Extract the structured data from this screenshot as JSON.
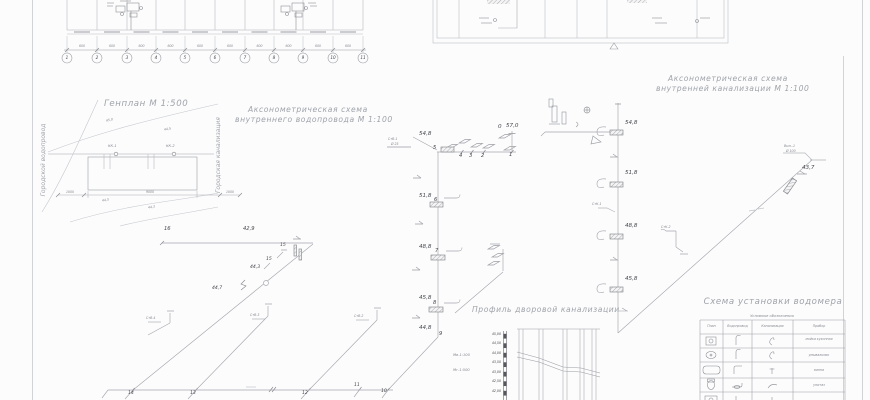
{
  "floor_plan": {
    "axes": [
      "1",
      "2",
      "3",
      "4",
      "5",
      "6",
      "7",
      "8",
      "9",
      "10",
      "11"
    ],
    "dims": [
      "600",
      "600",
      "600",
      "600",
      "600",
      "600",
      "600",
      "600",
      "600",
      "600"
    ]
  },
  "genplan": {
    "title": "Генплан  М 1:500",
    "left_main": "Городской водопровод",
    "right_main": "Городская канализация",
    "well1": "КК-1",
    "well2": "КК-2",
    "contours": [
      "45,0",
      "44,5",
      "44,5",
      "44,3"
    ],
    "dims": [
      "1000",
      "9000",
      "1000"
    ]
  },
  "water": {
    "title1": "Аксонометрическая схема",
    "title2": "внутреннего водопровода М 1:100",
    "riser_tag": "СтВ-1",
    "riser_dia": "Ø 25",
    "node0": "0",
    "elev0": "57,0",
    "top_nodes": [
      "4",
      "3",
      "2",
      "1"
    ],
    "levels": [
      {
        "elev": "54,8",
        "node": "5"
      },
      {
        "elev": "51,8",
        "node": "6"
      },
      {
        "elev": "48,8",
        "node": "7"
      },
      {
        "elev": "45,8",
        "node": "8"
      },
      {
        "elev": "44,8",
        "node": "9"
      }
    ],
    "left_node": "16",
    "left_elev": "42,9",
    "n15a": "15",
    "n15b": "15",
    "e443": "44,3",
    "e447": "44,7",
    "bottom_nodes": [
      "14",
      "13",
      "12",
      "11",
      "10"
    ],
    "tags": [
      "СтВ-4",
      "СтВ-3",
      "СтВ-2"
    ]
  },
  "sewer": {
    "title1": "Аксонометрическая схема",
    "title2": "внутренней канализации М 1:100",
    "levels": [
      "54,8",
      "51,8",
      "48,8",
      "45,8"
    ],
    "tag1": "СтК-1",
    "tag2": "СтК-2",
    "outlet1": "Вып.-1",
    "outlet2": "Ø 100",
    "outlet_elev": "43,7"
  },
  "profile": {
    "title": "Профиль дворовой канализации",
    "marks": [
      "45,00",
      "44,50",
      "44,00",
      "43,50",
      "43,00",
      "42,50",
      "42,00"
    ],
    "scale_v": "Мв-1:100",
    "scale_h": "Мг-1:500"
  },
  "meter": {
    "title": "Схема установки водомера",
    "legend": "Условные обозначения",
    "cols": [
      "План",
      "Водопровод",
      "Канализация",
      "Прибор"
    ],
    "rows": [
      "мойка кухонная",
      "умывальник",
      "ванна",
      "унитаз"
    ]
  }
}
